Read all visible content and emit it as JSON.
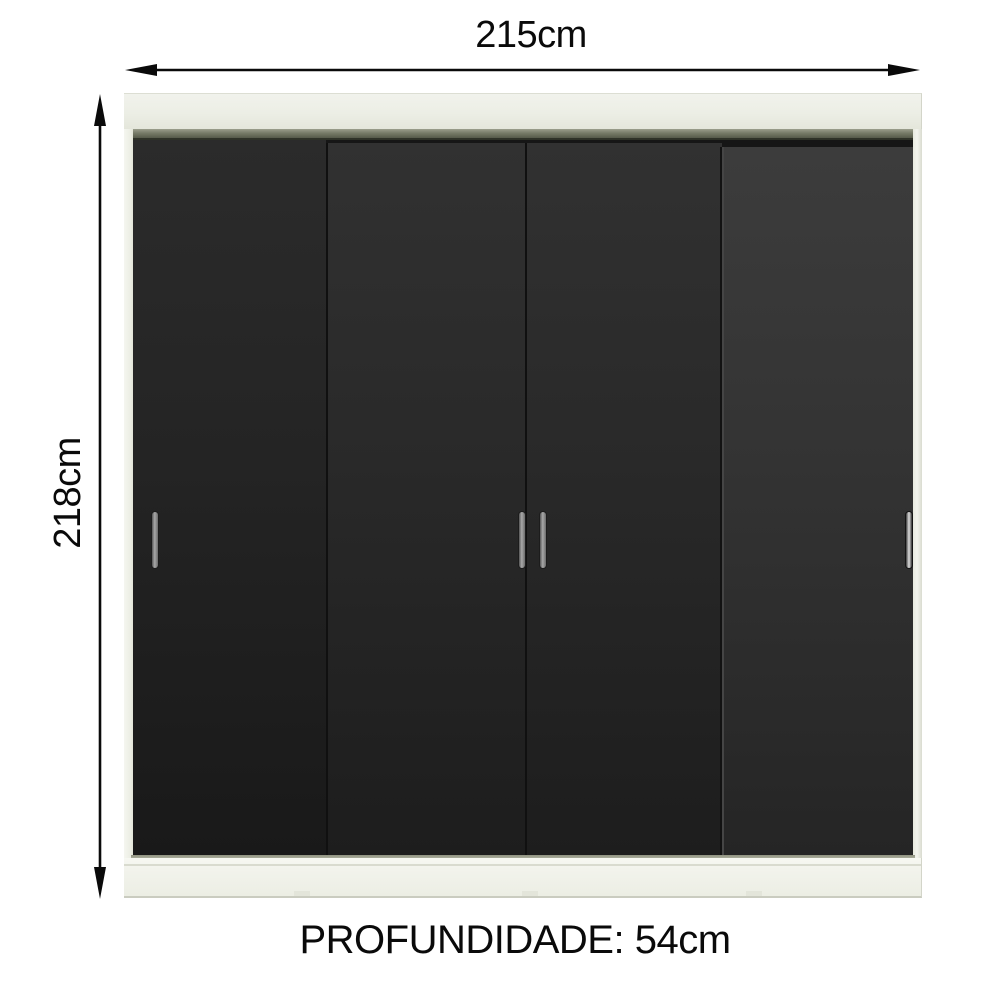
{
  "dimensions": {
    "width": {
      "label": "215cm",
      "value_cm": 215,
      "orientation": "horizontal"
    },
    "height": {
      "label": "218cm",
      "value_cm": 218,
      "orientation": "vertical"
    },
    "depth": {
      "label": "PROFUNDIDADE: 54cm",
      "value_cm": 54
    }
  },
  "wardrobe": {
    "door_count": 4,
    "handle_count": 4,
    "style": "sliding-door wardrobe, white frame with black doors"
  },
  "colors": {
    "background": "#ffffff",
    "annotation": "#0a0a0a",
    "frame": "#eef0e6",
    "track": "#777b68",
    "door_dark": "#262626",
    "door_light": "#343434",
    "handle": "#a8a8a8",
    "base": "#f2f3ec"
  }
}
